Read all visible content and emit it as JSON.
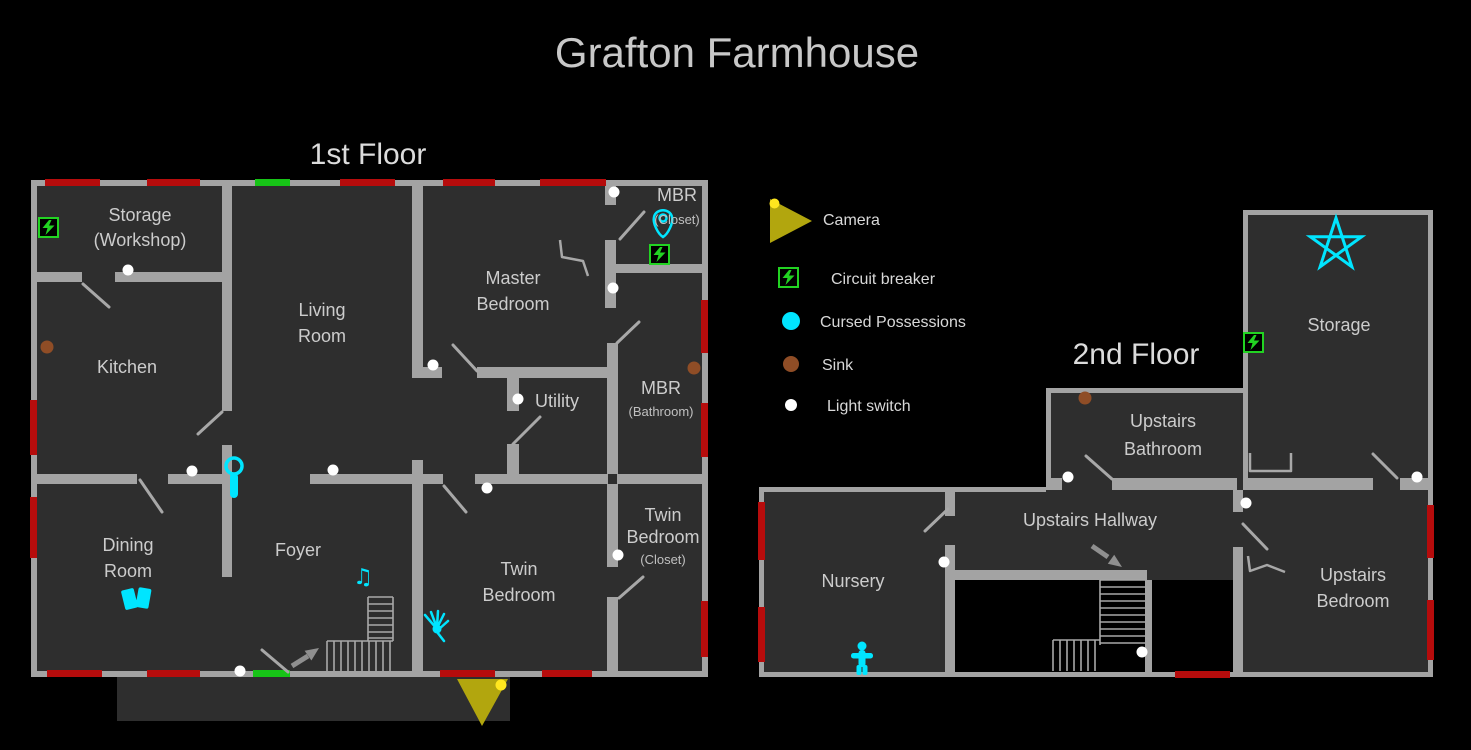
{
  "title": "Grafton Farmhouse",
  "floor1": {
    "heading": "1st Floor",
    "rooms": {
      "storage_l1": "Storage",
      "storage_l2": "(Workshop)",
      "kitchen": "Kitchen",
      "living_l1": "Living",
      "living_l2": "Room",
      "master_l1": "Master",
      "master_l2": "Bedroom",
      "mbr_closet_l1": "MBR",
      "mbr_closet_l2": "(Closet)",
      "mbr_bath_l1": "MBR",
      "mbr_bath_l2": "(Bathroom)",
      "utility": "Utility",
      "dining_l1": "Dining",
      "dining_l2": "Room",
      "foyer": "Foyer",
      "twin_l1": "Twin",
      "twin_l2": "Bedroom",
      "twin_closet_l1": "Twin",
      "twin_closet_l2": "Bedroom",
      "twin_closet_l3": "(Closet)"
    }
  },
  "floor2": {
    "heading": "2nd Floor",
    "rooms": {
      "storage": "Storage",
      "bathroom_l1": "Upstairs",
      "bathroom_l2": "Bathroom",
      "hallway": "Upstairs Hallway",
      "nursery": "Nursery",
      "bedroom_l1": "Upstairs",
      "bedroom_l2": "Bedroom"
    }
  },
  "legend": {
    "camera": "Camera",
    "circuit_breaker": "Circuit breaker",
    "cursed_possessions": "Cursed Possessions",
    "sink": "Sink",
    "light_switch": "Light switch"
  },
  "icons": {
    "music_box_glyph": "♫"
  },
  "colors": {
    "background": "#000000",
    "room": "#2e2e2e",
    "wall": "#a3a3a3",
    "window": "#b60c0c",
    "exit-door": "#17c417",
    "door-line": "#a8a8a8",
    "breaker": "#22d322",
    "cursed": "#00e5ff",
    "sink": "#8f4d26",
    "light-switch": "#ffffff",
    "camera": "#b2a60e",
    "camera-dot": "#ffe71f",
    "arrow": "#8f8f8f",
    "text": "#cccccc",
    "heading-text": "#dcdcdc",
    "title-text": "#c8c8c8"
  }
}
